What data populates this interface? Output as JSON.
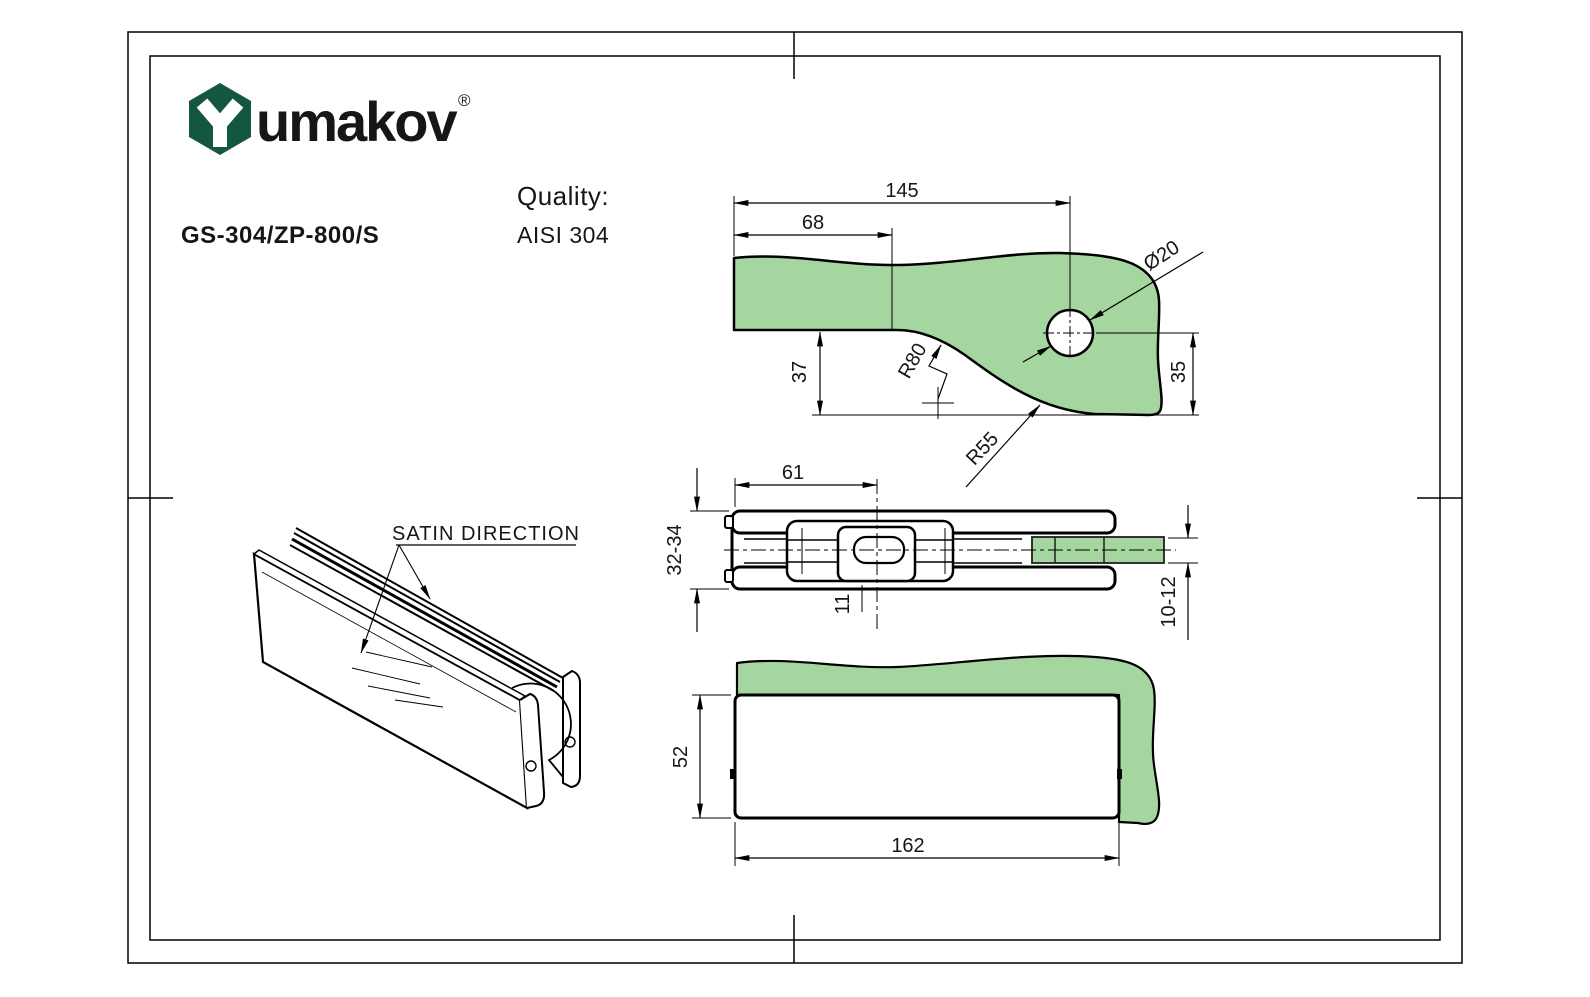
{
  "page": {
    "background": "#ffffff",
    "line_color": "#000000"
  },
  "logo": {
    "brand": "umakov",
    "registered": "®",
    "green": "#14573F"
  },
  "header": {
    "product_code": "GS-304/ZP-800/S",
    "quality_label": "Quality:",
    "quality_value": "AISI 304"
  },
  "colors": {
    "glass_green": "#A5D6A0",
    "logo_green": "#14573F",
    "line": "#000000"
  },
  "views": {
    "top": {
      "title": "glass-corner-plan-view",
      "dims": {
        "d145": "145",
        "d68": "68",
        "d37": "37",
        "d35": "35",
        "dia20": "Ø20",
        "r80": "R80",
        "r55": "R55"
      }
    },
    "section": {
      "title": "fitting-horizontal-section-view",
      "dims": {
        "d61": "61",
        "d32_34": "32-34",
        "d11": "11",
        "d10_12": "10-12"
      }
    },
    "front": {
      "title": "fitting-front-view",
      "dims": {
        "d52": "52",
        "d162": "162"
      }
    },
    "iso": {
      "title": "fitting-isometric-view",
      "satin_label": "SATIN DIRECTION"
    }
  }
}
